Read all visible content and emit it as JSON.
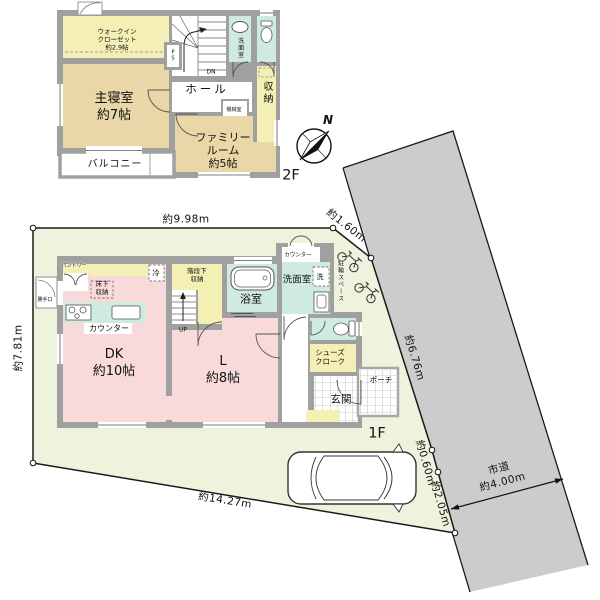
{
  "floor2": {
    "floor_label": "2F",
    "rooms": {
      "walk_in_closet": "ウォークイン\nクローゼット\n約2.9帖",
      "master_bedroom": "主寝室\n約7帖",
      "family_room": "ファミリー\nルーム\n約5帖",
      "balcony": "バルコニー",
      "hall": "ホール",
      "washroom": "洗面室",
      "storage": "収納",
      "machine_room": "機械室",
      "pipe_space": "P\nS",
      "stairs_down": "DN"
    }
  },
  "floor1": {
    "floor_label": "1F",
    "rooms": {
      "dining_kitchen": "DK\n約10帖",
      "living": "L\n約8帖",
      "bath": "浴室",
      "washroom": "洗面室",
      "washer": "洗",
      "washroom_counter": "カウンター",
      "kitchen_counter": "カウンター",
      "pantry": "パントリー",
      "fridge": "冷",
      "under_stair_storage": "階段下\n収納",
      "underfloor_storage": "床下\n収納",
      "stairs_up": "UP",
      "shoe_cloak": "シューズ\nクローク",
      "entrance": "玄関",
      "porch": "ポーチ",
      "back_door": "勝手口",
      "bicycle_space": "駐輪スペース"
    }
  },
  "site": {
    "dimensions": {
      "top": "約9.98m",
      "top_right": "約1.60m",
      "left": "約7.81m",
      "bottom": "約14.27m",
      "right_upper": "約6.76m",
      "right_mid": "約0.60m",
      "right_lower": "約2.05m"
    },
    "road_label": "市道\n約4.00m",
    "compass_north": "N"
  },
  "colors": {
    "site_fill": "#edf3dc",
    "road_fill": "#cccccc",
    "wall_gray": "#a0a0a0",
    "room_tan": "#ead7a8",
    "room_yellow": "#f4efb4",
    "room_teal": "#cfeade",
    "room_pink": "#f8dada"
  }
}
